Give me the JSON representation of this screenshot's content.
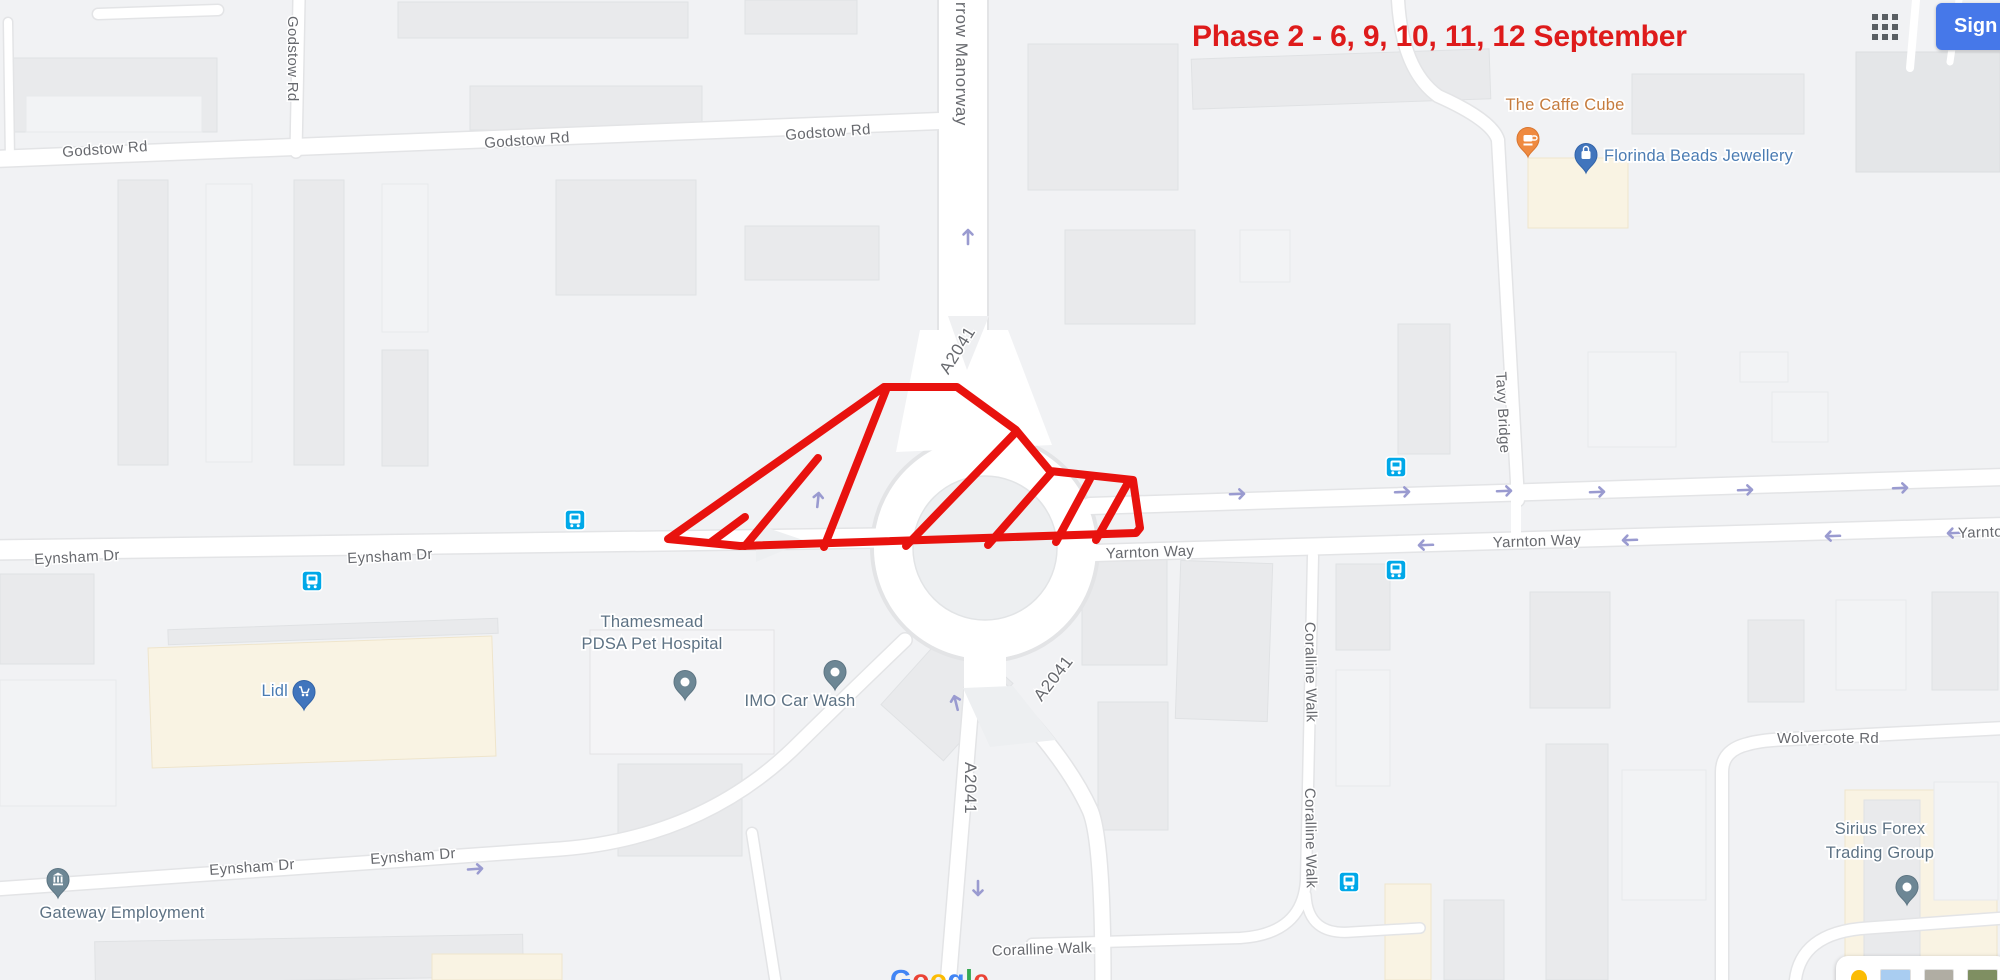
{
  "header": {
    "apps_menu_icon": "google-apps-grid-icon",
    "sign_in_label": "Sign in",
    "sign_in_color": "#4678e9"
  },
  "annotation": {
    "label": "Phase 2 - 6, 9, 10, 11, 12 September",
    "label_color": "#de1b1b",
    "highlight_style": "red-hatched-polygon-over-roundabout",
    "highlight_color": "#e8120e"
  },
  "map": {
    "road_labels": [
      {
        "text": "Godstow Rd"
      },
      {
        "text": "Godstow Rd"
      },
      {
        "text": "Godstow Rd"
      },
      {
        "text": "Godstow Rd"
      },
      {
        "text": "rrow Manorway"
      },
      {
        "text": "A2041"
      },
      {
        "text": "Eynsham Dr"
      },
      {
        "text": "Eynsham Dr"
      },
      {
        "text": "Yarnton Way"
      },
      {
        "text": "Yarnton Way"
      },
      {
        "text": "Yarnton Way"
      },
      {
        "text": "Tavy Bridge"
      },
      {
        "text": "A2041"
      },
      {
        "text": "A2041"
      },
      {
        "text": "Coralline Walk"
      },
      {
        "text": "Coralline Walk"
      },
      {
        "text": "Coralline Walk"
      },
      {
        "text": "Wolvercote Rd"
      },
      {
        "text": "Eynsham Dr"
      },
      {
        "text": "Eynsham Dr"
      }
    ],
    "pois": [
      {
        "name": "The Caffe Cube",
        "icon": "coffee-cup-pin-icon",
        "color": "#c57b3d"
      },
      {
        "name": "Florinda Beads Jewellery",
        "icon": "shopping-bag-pin-icon",
        "color": "#4b7cb3"
      },
      {
        "name_line1": "Thamesmead",
        "name_line2": "PDSA Pet Hospital",
        "icon": "generic-pin-icon",
        "color": "#5d7284"
      },
      {
        "name": "IMO Car Wash",
        "icon": "generic-pin-icon",
        "color": "#5d7284"
      },
      {
        "name": "Lidl",
        "icon": "shopping-cart-pin-icon",
        "color": "#4b7cb3"
      },
      {
        "name": "Gateway Employment",
        "icon": "bank-pin-icon",
        "color": "#5d7284"
      },
      {
        "name_line1": "Sirius Forex",
        "name_line2": "Trading Group",
        "icon": "generic-pin-icon",
        "color": "#5d7284"
      }
    ],
    "transit_stops": {
      "icon": "bus-transit-icon",
      "count": 5,
      "color": "#00a8e8"
    },
    "direction_arrow_color": "#9a9bd0"
  },
  "watermark": {
    "text": "Google",
    "letter_colors": [
      "#4285F4",
      "#EA4335",
      "#FBBC05",
      "#4285F4",
      "#34A853",
      "#EA4335"
    ]
  },
  "imagery_bar": {
    "pegman_icon": "pegman-icon",
    "pegman_color": "#fbbc04",
    "thumbnails": [
      "map-thumbnail",
      "satellite-thumbnail",
      "terrain-thumbnail"
    ]
  }
}
